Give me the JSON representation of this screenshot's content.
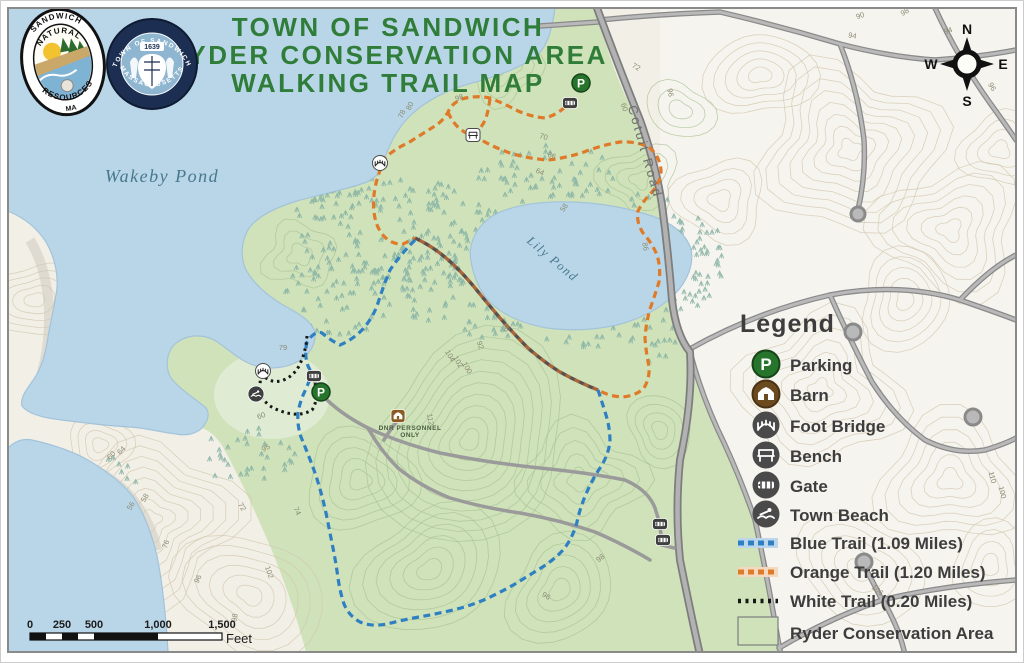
{
  "header": {
    "title_line1": "TOWN OF SANDWICH",
    "title_line2": "RYDER CONSERVATION AREA",
    "title_line3": "WALKING TRAIL MAP"
  },
  "logos": {
    "natural_resources": {
      "arc_top": "SANDWICH",
      "arc_mid": "NATURAL",
      "arc_bottom": "RESOURCES",
      "suffix": "MA"
    },
    "town_seal": {
      "arc_top": "TOWN OF SANDWICH",
      "arc_bottom": "MASSACHUSETTS",
      "year": "1639"
    }
  },
  "map_labels": {
    "wakeby_pond": "Wakeby Pond",
    "lily_pond": "Lily Pond",
    "cotuit_road": "Cotuit Road",
    "dnr_line1": "DNR PERSONNEL",
    "dnr_line2": "ONLY",
    "contours": [
      {
        "t": "98",
        "x": 460,
        "y": 100,
        "r": -20
      },
      {
        "t": "80",
        "x": 412,
        "y": 107,
        "r": -65
      },
      {
        "t": "78",
        "x": 404,
        "y": 115,
        "r": -65
      },
      {
        "t": "70",
        "x": 543,
        "y": 139,
        "r": 15
      },
      {
        "t": "66",
        "x": 551,
        "y": 158,
        "r": 20
      },
      {
        "t": "64",
        "x": 539,
        "y": 174,
        "r": 25
      },
      {
        "t": "58",
        "x": 566,
        "y": 209,
        "r": -55
      },
      {
        "t": "86",
        "x": 643,
        "y": 247,
        "r": 80
      },
      {
        "t": "88",
        "x": 504,
        "y": 328,
        "r": 75
      },
      {
        "t": "92",
        "x": 478,
        "y": 346,
        "r": 70
      },
      {
        "t": "104",
        "x": 448,
        "y": 357,
        "r": 60
      },
      {
        "t": "102",
        "x": 456,
        "y": 363,
        "r": 60
      },
      {
        "t": "100",
        "x": 465,
        "y": 369,
        "r": 60
      },
      {
        "t": "72",
        "x": 635,
        "y": 69,
        "r": 30
      },
      {
        "t": "60",
        "x": 622,
        "y": 108,
        "r": 70
      },
      {
        "t": "96",
        "x": 668,
        "y": 93,
        "r": 80
      },
      {
        "t": "94",
        "x": 949,
        "y": 33,
        "r": -20
      },
      {
        "t": "98",
        "x": 906,
        "y": 14,
        "r": -30
      },
      {
        "t": "90",
        "x": 861,
        "y": 18,
        "r": -20
      },
      {
        "t": "96",
        "x": 990,
        "y": 88,
        "r": 60
      },
      {
        "t": "56",
        "x": 133,
        "y": 507,
        "r": -60
      },
      {
        "t": "58",
        "x": 147,
        "y": 499,
        "r": -60
      },
      {
        "t": "64",
        "x": 123,
        "y": 452,
        "r": -45
      },
      {
        "t": "60",
        "x": 113,
        "y": 457,
        "r": -45
      },
      {
        "t": "76",
        "x": 168,
        "y": 545,
        "r": -70
      },
      {
        "t": "96",
        "x": 200,
        "y": 580,
        "r": -65
      },
      {
        "t": "98",
        "x": 237,
        "y": 618,
        "r": -80
      },
      {
        "t": "102",
        "x": 267,
        "y": 573,
        "r": 70
      },
      {
        "t": "72",
        "x": 240,
        "y": 508,
        "r": 60
      },
      {
        "t": "74",
        "x": 295,
        "y": 512,
        "r": 65
      },
      {
        "t": "112",
        "x": 428,
        "y": 420,
        "r": 80
      },
      {
        "t": "110",
        "x": 990,
        "y": 478,
        "r": 75
      },
      {
        "t": "100",
        "x": 1000,
        "y": 493,
        "r": 75
      },
      {
        "t": "106",
        "x": 876,
        "y": 592,
        "r": 40
      },
      {
        "t": "96",
        "x": 545,
        "y": 598,
        "r": 30
      },
      {
        "t": "98",
        "x": 602,
        "y": 560,
        "r": -40
      },
      {
        "t": "79",
        "x": 283,
        "y": 350,
        "r": 0
      },
      {
        "t": "60",
        "x": 262,
        "y": 418,
        "r": -20
      },
      {
        "t": "95",
        "x": 267,
        "y": 450,
        "r": -30
      },
      {
        "t": "94",
        "x": 852,
        "y": 38,
        "r": 10
      }
    ]
  },
  "glyphs": {
    "p": "P"
  },
  "legend": {
    "title": "Legend",
    "items": [
      {
        "label": "Parking",
        "icon": "parking-icon"
      },
      {
        "label": "Barn",
        "icon": "barn-icon"
      },
      {
        "label": "Foot Bridge",
        "icon": "foot-bridge-icon"
      },
      {
        "label": "Bench",
        "icon": "bench-icon"
      },
      {
        "label": "Gate",
        "icon": "gate-icon"
      },
      {
        "label": "Town Beach",
        "icon": "town-beach-icon"
      }
    ],
    "trails": [
      {
        "label": "Blue Trail (1.09 Miles)",
        "color": "#2f80c3"
      },
      {
        "label": "Orange Trail (1.20 Miles)",
        "color": "#df7a28"
      },
      {
        "label": "White Trail (0.20 Miles)",
        "color": "#161616"
      }
    ],
    "area": {
      "label": "Ryder Conservation Area",
      "fill": "#cfe2b9"
    }
  },
  "compass": {
    "n": "N",
    "e": "E",
    "s": "S",
    "w": "W"
  },
  "scale_bar": {
    "ticks": [
      "0",
      "250",
      "500",
      "1,000",
      "1,500"
    ],
    "unit": "Feet"
  },
  "colors": {
    "water": "#b9d6e8",
    "land": "#f2efe6",
    "conservation": "#cfe2b9",
    "blue_trail": "#2f80c3",
    "orange_trail": "#df7a28",
    "white_trail": "#161616",
    "title_green": "#2f7d38",
    "road_gray": "#b0b0b0"
  }
}
